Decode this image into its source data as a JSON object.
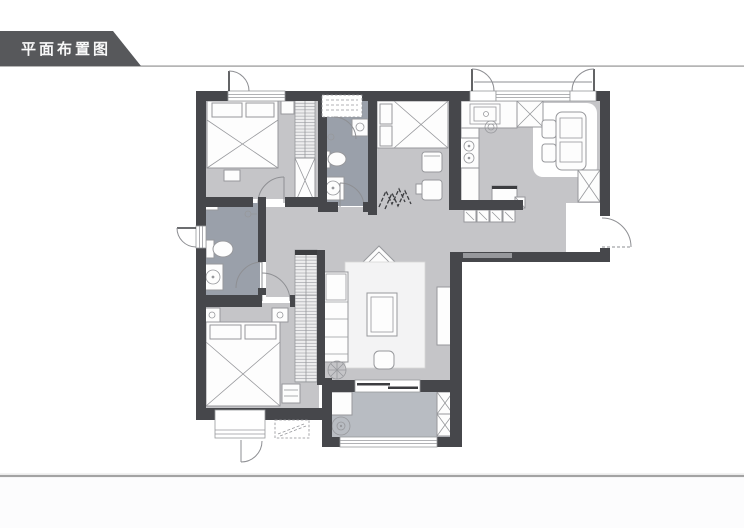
{
  "header": {
    "title": "平面布置图"
  },
  "colors": {
    "page_bg": "#ffffff",
    "banner": "#57585b",
    "banner_text": "#f8f8f8",
    "rule": "#a3a3a3",
    "rule_soft": "#dedede",
    "below_rule_bg": "#fcfcfd",
    "wall": "#46474b",
    "wall_light": "#97989c",
    "floor": "#c5c5c8",
    "floor_dark": "#9aa0aa",
    "floor_balcony": "#b8bcc2",
    "furn_fill": "#fdfdfd",
    "furn_stroke": "#97989c",
    "hatch_bg": "#ededee",
    "door_arc": "#8e8f93",
    "decor_dark": "#3c3d40"
  },
  "plan": {
    "regions": [
      "master-bedroom",
      "bathroom-top",
      "study-bedroom",
      "kitchen-dining",
      "hallway",
      "bathroom-left",
      "second-bedroom",
      "living-room",
      "balcony",
      "entry"
    ],
    "icons": [
      "double-bed-icon",
      "single-bed-icon",
      "wardrobe-icon",
      "nightstand-icon",
      "toilet-icon",
      "washbasin-icon",
      "shower-icon",
      "kitchen-sink-icon",
      "stove-icon",
      "fridge-icon",
      "dining-table-icon",
      "chair-icon",
      "sofa-icon",
      "coffee-table-icon",
      "tv-cabinet-icon",
      "rug-icon",
      "washing-machine-icon",
      "storage-cabinet-icon",
      "window-icon",
      "door-swing-icon",
      "sliding-door-icon",
      "zigzag-decor-icon",
      "ceiling-fan-icon"
    ]
  }
}
